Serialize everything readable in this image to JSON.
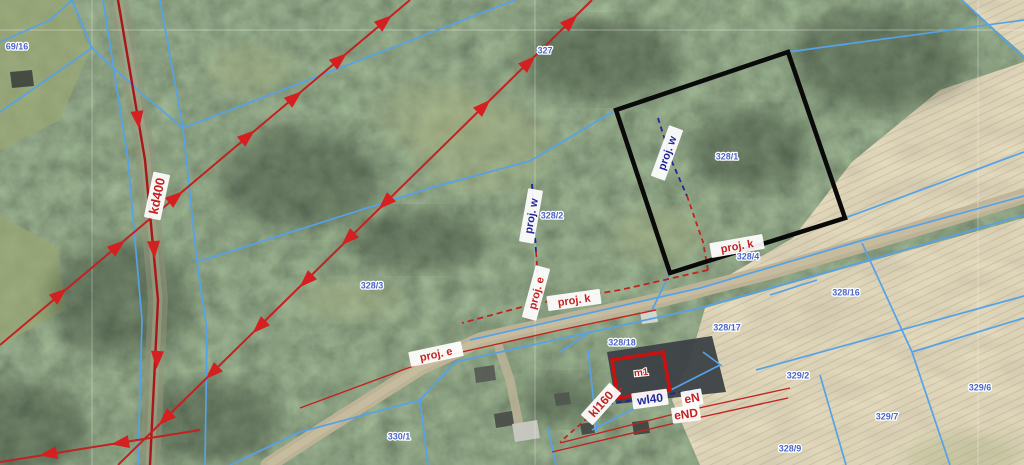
{
  "map": {
    "colors": {
      "parcel_line": "#55a2e8",
      "utility_red": "#c22222",
      "utility_dark_red": "#a81818",
      "utility_navy": "#24249a",
      "arrow_red": "#d42020",
      "selection_black": "#0a0a0a",
      "building_red": "#cc1010",
      "parcel_label_blue": "#4a66c8",
      "forest_base": "#49543f",
      "field_base": "#c4b795",
      "road": "#bfb397"
    },
    "parcel_labels": [
      {
        "text": "69/16",
        "x": 17,
        "y": 47
      },
      {
        "text": "327",
        "x": 545,
        "y": 51
      },
      {
        "text": "328/1",
        "x": 727,
        "y": 157
      },
      {
        "text": "328/2",
        "x": 552,
        "y": 216
      },
      {
        "text": "328/3",
        "x": 372,
        "y": 286
      },
      {
        "text": "328/4",
        "x": 748,
        "y": 257
      },
      {
        "text": "328/16",
        "x": 846,
        "y": 293
      },
      {
        "text": "328/17",
        "x": 727,
        "y": 328
      },
      {
        "text": "328/18",
        "x": 622,
        "y": 343
      },
      {
        "text": "329/2",
        "x": 798,
        "y": 376
      },
      {
        "text": "329/6",
        "x": 980,
        "y": 388
      },
      {
        "text": "329/7",
        "x": 887,
        "y": 417
      },
      {
        "text": "328/9",
        "x": 790,
        "y": 449
      },
      {
        "text": "330/1",
        "x": 399,
        "y": 437
      }
    ],
    "utility_labels": [
      {
        "text": "kd400",
        "x": 157,
        "y": 196,
        "rot": -78,
        "color": "red",
        "fs": 13
      },
      {
        "text": "proj. w",
        "x": 667,
        "y": 153,
        "rot": -70,
        "color": "navy",
        "fs": 11
      },
      {
        "text": "proj. k",
        "x": 737,
        "y": 246,
        "rot": -10,
        "color": "red",
        "fs": 11
      },
      {
        "text": "proj. w",
        "x": 531,
        "y": 216,
        "rot": -80,
        "color": "navy",
        "fs": 11
      },
      {
        "text": "proj. e",
        "x": 536,
        "y": 293,
        "rot": -75,
        "color": "red",
        "fs": 11
      },
      {
        "text": "proj. k",
        "x": 574,
        "y": 300,
        "rot": -8,
        "color": "red",
        "fs": 11
      },
      {
        "text": "proj. e",
        "x": 436,
        "y": 354,
        "rot": -12,
        "color": "red",
        "fs": 11
      },
      {
        "text": "kl160",
        "x": 601,
        "y": 404,
        "rot": -48,
        "color": "red",
        "fs": 12
      },
      {
        "text": "wl40",
        "x": 650,
        "y": 399,
        "rot": -8,
        "color": "navy",
        "fs": 12
      },
      {
        "text": "eN",
        "x": 692,
        "y": 398,
        "rot": -10,
        "color": "red",
        "fs": 12
      },
      {
        "text": "eND",
        "x": 686,
        "y": 414,
        "rot": -8,
        "color": "red",
        "fs": 12
      },
      {
        "text": "m1",
        "x": 641,
        "y": 372,
        "rot": -6,
        "color": "red",
        "fs": 10,
        "nobg": true
      }
    ],
    "selection_polygon": [
      [
        616,
        110
      ],
      [
        788,
        52
      ],
      [
        845,
        218
      ],
      [
        670,
        273
      ]
    ],
    "building_outline": [
      [
        612,
        360
      ],
      [
        663,
        352
      ],
      [
        670,
        390
      ],
      [
        618,
        398
      ]
    ],
    "graticule": {
      "h": [
        30
      ],
      "v": [
        92,
        535,
        978
      ]
    },
    "parcel_lines": [
      [
        [
          72,
          0
        ],
        [
          50,
          20
        ],
        [
          0,
          42
        ]
      ],
      [
        [
          72,
          0
        ],
        [
          92,
          48
        ]
      ],
      [
        [
          92,
          48
        ],
        [
          0,
          112
        ]
      ],
      [
        [
          92,
          48
        ],
        [
          140,
          92
        ],
        [
          183,
          128
        ]
      ],
      [
        [
          103,
          0
        ],
        [
          128,
          160
        ],
        [
          142,
          320
        ],
        [
          138,
          465
        ]
      ],
      [
        [
          160,
          0
        ],
        [
          183,
          128
        ],
        [
          197,
          262
        ],
        [
          207,
          330
        ],
        [
          205,
          465
        ]
      ],
      [
        [
          183,
          128
        ],
        [
          350,
          64
        ],
        [
          515,
          0
        ]
      ],
      [
        [
          197,
          262
        ],
        [
          430,
          188
        ],
        [
          530,
          161
        ],
        [
          616,
          110
        ]
      ],
      [
        [
          788,
          52
        ],
        [
          1024,
          20
        ]
      ],
      [
        [
          845,
          218
        ],
        [
          1024,
          152
        ]
      ],
      [
        [
          470,
          340
        ],
        [
          700,
          288
        ],
        [
          860,
          241
        ],
        [
          1024,
          196
        ]
      ],
      [
        [
          455,
          362
        ],
        [
          700,
          308
        ],
        [
          870,
          260
        ],
        [
          1024,
          215
        ]
      ],
      [
        [
          862,
          243
        ],
        [
          912,
          352
        ],
        [
          950,
          465
        ]
      ],
      [
        [
          912,
          352
        ],
        [
          1024,
          318
        ]
      ],
      [
        [
          820,
          375
        ],
        [
          846,
          465
        ]
      ],
      [
        [
          756,
          370
        ],
        [
          1024,
          296
        ]
      ],
      [
        [
          770,
          295
        ],
        [
          817,
          280
        ]
      ],
      [
        [
          560,
          352
        ],
        [
          590,
          332
        ]
      ],
      [
        [
          588,
          350
        ],
        [
          597,
          432
        ]
      ],
      [
        [
          592,
          430
        ],
        [
          720,
          365
        ]
      ],
      [
        [
          703,
          352
        ],
        [
          722,
          366
        ]
      ],
      [
        [
          230,
          465
        ],
        [
          300,
          432
        ],
        [
          420,
          400
        ],
        [
          455,
          362
        ]
      ],
      [
        [
          420,
          400
        ],
        [
          428,
          465
        ]
      ],
      [
        [
          548,
          428
        ],
        [
          556,
          465
        ]
      ],
      [
        [
          962,
          0
        ],
        [
          1024,
          58
        ]
      ],
      [
        [
          670,
          273
        ],
        [
          652,
          310
        ]
      ]
    ],
    "utility_lines": [
      {
        "id": "kd-road",
        "color": "dred",
        "width": 2.4,
        "points": [
          [
            118,
            0
          ],
          [
            145,
            160
          ],
          [
            158,
            300
          ],
          [
            150,
            465
          ]
        ]
      },
      {
        "id": "ditch-a",
        "color": "red",
        "width": 2,
        "points": [
          [
            0,
            345
          ],
          [
            410,
            0
          ]
        ]
      },
      {
        "id": "ditch-b",
        "color": "red",
        "width": 2,
        "points": [
          [
            118,
            465
          ],
          [
            592,
            0
          ]
        ]
      },
      {
        "id": "ditch-c",
        "color": "red",
        "width": 2,
        "points": [
          [
            200,
            430
          ],
          [
            0,
            462
          ]
        ]
      },
      {
        "id": "proj-w-1",
        "color": "navy",
        "dash": "5 4",
        "width": 1.8,
        "points": [
          [
            658,
            118
          ],
          [
            672,
            162
          ],
          [
            687,
            196
          ]
        ]
      },
      {
        "id": "proj-k-1",
        "color": "red",
        "dash": "5 4",
        "width": 1.8,
        "points": [
          [
            687,
            196
          ],
          [
            703,
            242
          ],
          [
            708,
            270
          ]
        ]
      },
      {
        "id": "proj-w-2",
        "color": "navy",
        "dash": "5 4",
        "width": 1.8,
        "points": [
          [
            532,
            184
          ],
          [
            536,
            252
          ]
        ]
      },
      {
        "id": "proj-e-2",
        "color": "red",
        "dash": "5 4",
        "width": 1.8,
        "points": [
          [
            536,
            252
          ],
          [
            540,
            302
          ]
        ]
      },
      {
        "id": "proj-k-2",
        "color": "red",
        "dash": "6 4",
        "width": 1.8,
        "points": [
          [
            708,
            270
          ],
          [
            620,
            290
          ],
          [
            533,
            304
          ],
          [
            462,
            323
          ]
        ]
      },
      {
        "id": "kl-line",
        "color": "red",
        "dash": "5 4",
        "width": 1.8,
        "points": [
          [
            622,
            388
          ],
          [
            560,
            442
          ]
        ]
      },
      {
        "id": "wl-line",
        "color": "navy",
        "dash": "5 4",
        "width": 1.8,
        "points": [
          [
            608,
            404
          ],
          [
            700,
            389
          ]
        ]
      },
      {
        "id": "e-line",
        "color": "red",
        "width": 1.4,
        "points": [
          [
            300,
            408
          ],
          [
            435,
            358
          ],
          [
            560,
            330
          ],
          [
            656,
            310
          ]
        ]
      },
      {
        "id": "en-line",
        "color": "red",
        "width": 1.4,
        "points": [
          [
            560,
            443
          ],
          [
            690,
            410
          ],
          [
            790,
            388
          ]
        ]
      },
      {
        "id": "end-line",
        "color": "red",
        "width": 1.4,
        "points": [
          [
            552,
            452
          ],
          [
            688,
            420
          ],
          [
            788,
            398
          ]
        ]
      }
    ],
    "flow_arrows": [
      {
        "x": 60,
        "y": 294,
        "a": -40
      },
      {
        "x": 118,
        "y": 246,
        "a": -40
      },
      {
        "x": 176,
        "y": 197,
        "a": -40
      },
      {
        "x": 248,
        "y": 136,
        "a": -40
      },
      {
        "x": 295,
        "y": 97,
        "a": -40
      },
      {
        "x": 340,
        "y": 59,
        "a": -40
      },
      {
        "x": 385,
        "y": 21,
        "a": -40
      },
      {
        "x": 484,
        "y": 106,
        "a": -44
      },
      {
        "x": 529,
        "y": 62,
        "a": -44
      },
      {
        "x": 571,
        "y": 21,
        "a": -44
      },
      {
        "x": 165,
        "y": 419,
        "a": 136
      },
      {
        "x": 212,
        "y": 373,
        "a": 136
      },
      {
        "x": 259,
        "y": 327,
        "a": 136
      },
      {
        "x": 306,
        "y": 281,
        "a": 136
      },
      {
        "x": 348,
        "y": 239,
        "a": 136
      },
      {
        "x": 385,
        "y": 203,
        "a": 136
      },
      {
        "x": 138,
        "y": 120,
        "a": 83
      },
      {
        "x": 154,
        "y": 250,
        "a": 87
      },
      {
        "x": 157,
        "y": 360,
        "a": 93
      },
      {
        "x": 120,
        "y": 443,
        "a": 171
      },
      {
        "x": 48,
        "y": 454,
        "a": 171
      }
    ],
    "regions": {
      "field_upper": [
        [
          700,
          292
        ],
        [
          793,
          238
        ],
        [
          852,
          162
        ],
        [
          940,
          90
        ],
        [
          1024,
          62
        ],
        [
          1024,
          198
        ],
        [
          860,
          243
        ]
      ],
      "field_lower": [
        [
          705,
          308
        ],
        [
          1024,
          218
        ],
        [
          1024,
          465
        ],
        [
          700,
          465
        ],
        [
          672,
          400
        ],
        [
          690,
          360
        ]
      ],
      "field_corner": [
        [
          962,
          0
        ],
        [
          1024,
          0
        ],
        [
          1024,
          55
        ]
      ],
      "meadow_nw": [
        [
          0,
          0
        ],
        [
          68,
          0
        ],
        [
          90,
          50
        ],
        [
          60,
          120
        ],
        [
          0,
          150
        ]
      ],
      "meadow_w": [
        [
          0,
          215
        ],
        [
          58,
          248
        ],
        [
          66,
          310
        ],
        [
          0,
          345
        ]
      ]
    },
    "roads": {
      "main": [
        [
          268,
          465
        ],
        [
          330,
          425
        ],
        [
          420,
          368
        ],
        [
          480,
          340
        ],
        [
          560,
          322
        ],
        [
          660,
          300
        ],
        [
          770,
          272
        ],
        [
          880,
          240
        ],
        [
          1024,
          196
        ]
      ],
      "left": [
        [
          118,
          0
        ],
        [
          145,
          150
        ],
        [
          158,
          300
        ],
        [
          150,
          465
        ]
      ],
      "driveway": [
        [
          497,
          342
        ],
        [
          510,
          380
        ],
        [
          520,
          430
        ]
      ]
    },
    "buildings": [
      {
        "poly": [
          [
            607,
            352
          ],
          [
            712,
            336
          ],
          [
            726,
            392
          ],
          [
            616,
            404
          ]
        ],
        "fill": "#3c4146"
      },
      {
        "poly": [
          [
            474,
            368
          ],
          [
            494,
            365
          ],
          [
            496,
            380
          ],
          [
            476,
            383
          ]
        ],
        "fill": "#565c55"
      },
      {
        "poly": [
          [
            494,
            414
          ],
          [
            512,
            411
          ],
          [
            514,
            425
          ],
          [
            496,
            428
          ]
        ],
        "fill": "#4a4f4a"
      },
      {
        "poly": [
          [
            512,
            424
          ],
          [
            537,
            420
          ],
          [
            540,
            438
          ],
          [
            515,
            442
          ]
        ],
        "fill": "#c8c8c2"
      },
      {
        "poly": [
          [
            554,
            394
          ],
          [
            569,
            392
          ],
          [
            571,
            404
          ],
          [
            556,
            406
          ]
        ],
        "fill": "#50564f"
      },
      {
        "poly": [
          [
            580,
            424
          ],
          [
            593,
            422
          ],
          [
            595,
            433
          ],
          [
            582,
            435
          ]
        ],
        "fill": "#444a44"
      },
      {
        "poly": [
          [
            632,
            422
          ],
          [
            648,
            420
          ],
          [
            650,
            433
          ],
          [
            634,
            435
          ]
        ],
        "fill": "#3f453f"
      },
      {
        "poly": [
          [
            640,
            312
          ],
          [
            656,
            310
          ],
          [
            658,
            322
          ],
          [
            642,
            324
          ]
        ],
        "fill": "#d8d8d2"
      },
      {
        "poly": [
          [
            10,
            72
          ],
          [
            32,
            70
          ],
          [
            34,
            86
          ],
          [
            12,
            88
          ]
        ],
        "fill": "#41473f"
      }
    ],
    "dark_patches": [
      {
        "x": 300,
        "y": 180,
        "rx": 80,
        "ry": 50
      },
      {
        "x": 120,
        "y": 300,
        "rx": 70,
        "ry": 60
      },
      {
        "x": 600,
        "y": 60,
        "rx": 80,
        "ry": 40
      },
      {
        "x": 750,
        "y": 150,
        "rx": 60,
        "ry": 40
      },
      {
        "x": 420,
        "y": 240,
        "rx": 70,
        "ry": 30
      },
      {
        "x": 0,
        "y": 430,
        "rx": 90,
        "ry": 50
      },
      {
        "x": 880,
        "y": 60,
        "rx": 90,
        "ry": 50
      },
      {
        "x": 560,
        "y": 400,
        "rx": 40,
        "ry": 25
      },
      {
        "x": 210,
        "y": 420,
        "rx": 70,
        "ry": 40
      }
    ],
    "light_patches": [
      {
        "x": 435,
        "y": 115,
        "rx": 55,
        "ry": 35
      },
      {
        "x": 250,
        "y": 70,
        "rx": 40,
        "ry": 25
      },
      {
        "x": 660,
        "y": 235,
        "rx": 45,
        "ry": 25
      },
      {
        "x": 480,
        "y": 145,
        "rx": 70,
        "ry": 45
      },
      {
        "x": 350,
        "y": 300,
        "rx": 50,
        "ry": 20
      },
      {
        "x": 965,
        "y": 455,
        "rx": 60,
        "ry": 22
      }
    ]
  }
}
